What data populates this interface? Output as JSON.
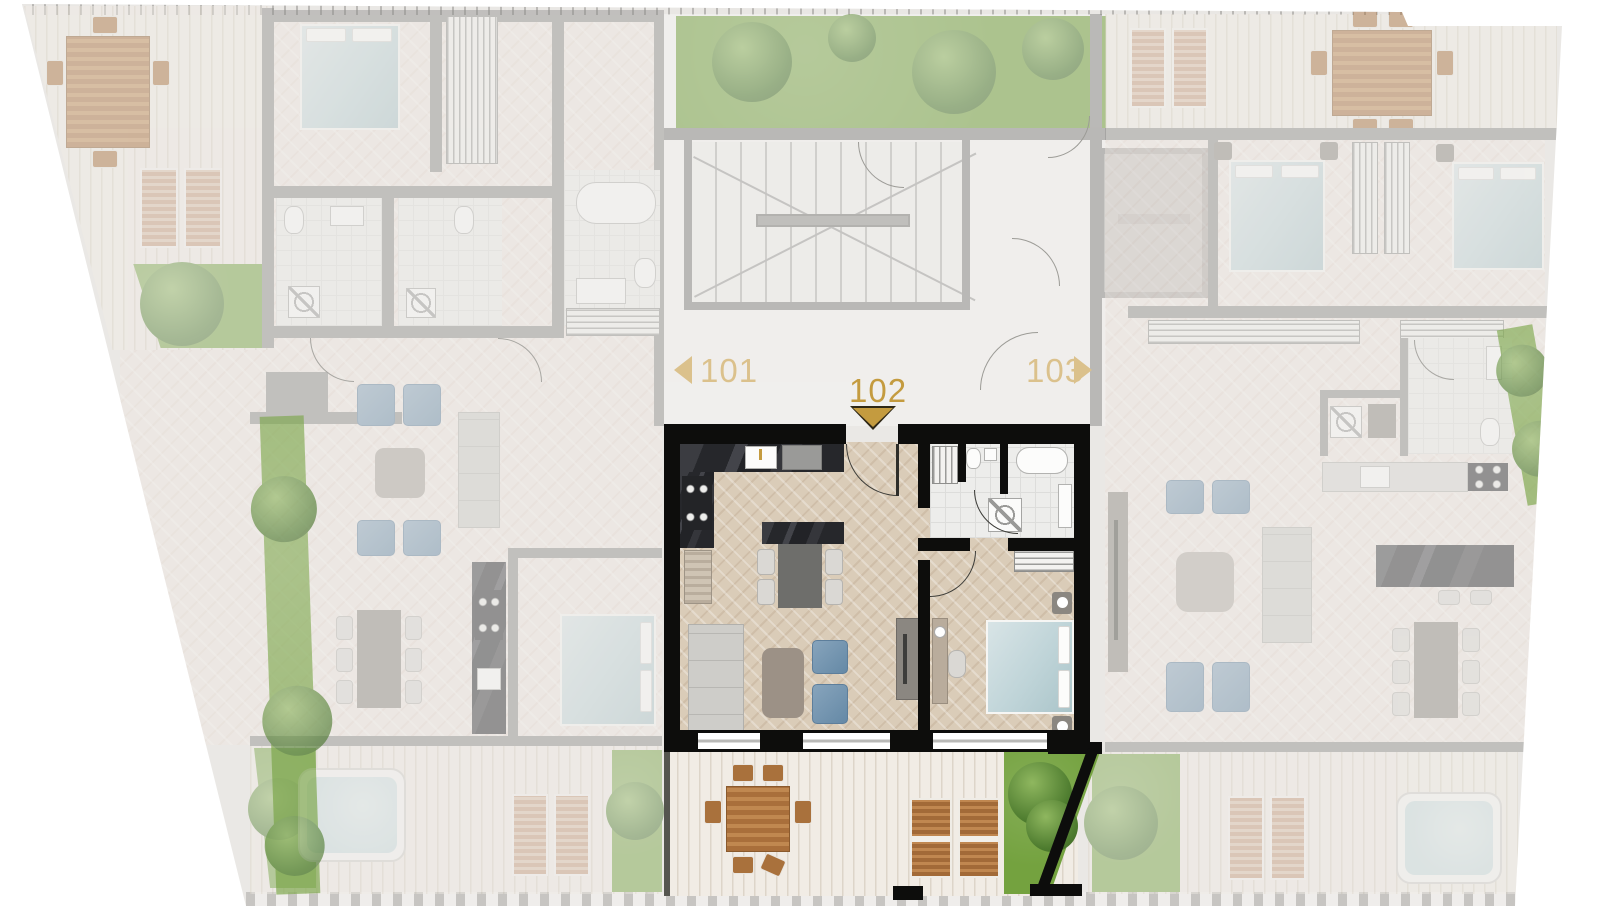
{
  "navigation": {
    "prev": {
      "label": "101",
      "arrow": "left"
    },
    "current": {
      "label": "102",
      "marker": "down-triangle"
    },
    "next": {
      "label": "103",
      "arrow": "right"
    }
  },
  "units": [
    {
      "id": "101",
      "state": "dimmed",
      "position": "left"
    },
    {
      "id": "102",
      "state": "selected",
      "position": "center"
    },
    {
      "id": "103",
      "state": "dimmed",
      "position": "right"
    }
  ],
  "colors": {
    "gold": "#C49B3F",
    "goldSoft": "#DBC18C",
    "goldEdge": "#2E2715",
    "wallSel": "#0D0D0C",
    "wallDim": "#8E8E8C",
    "floorSel": "#DACCB8",
    "floorDim": "#EFE7E1",
    "floorCommon": "#F6F5F3",
    "shell": "#EAE8E5",
    "deck": "#F1ECE5",
    "deckLine": "#DDD5C9",
    "tile": "#EDEDEB",
    "grass": "#74A23F",
    "grassDeep": "#4A782B",
    "wood": "#B0763C",
    "bedTeal": "#BDD3D7",
    "pool": "#C9DCDF",
    "blue": "#7493AE"
  }
}
